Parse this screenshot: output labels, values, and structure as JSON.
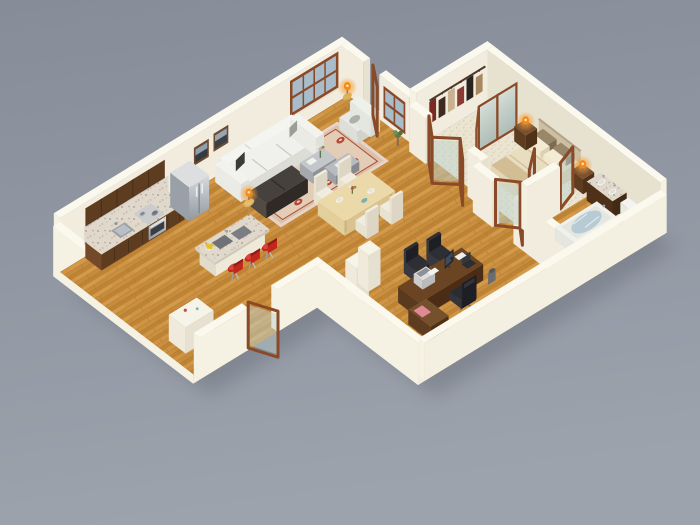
{
  "scene": {
    "type": "3d-floor-plan-render",
    "description": "Isometric 3D rendering of a one-bedroom apartment floor plan viewed from above on a gray background",
    "background": "gray gradient",
    "rooms": [
      {
        "name": "kitchen",
        "items": [
          "upper wall cabinets",
          "granite counter",
          "range with oven and pots",
          "sink",
          "stainless refrigerator",
          "granite island with prep sinks",
          "fruit bowl",
          "red bar stools"
        ]
      },
      {
        "name": "living-room",
        "items": [
          "white sofa",
          "dark sofa",
          "armchair",
          "metal coffee tables",
          "patterned area rug",
          "orange table lamps",
          "framed wall art",
          "large window",
          "open balcony door",
          "potted plant"
        ]
      },
      {
        "name": "dining-area",
        "items": [
          "light wood dining table",
          "four cream chairs",
          "plates",
          "teal bowl",
          "centerpiece"
        ]
      },
      {
        "name": "bedroom",
        "items": [
          "double bed with cream duvet",
          "brown and cream pillows",
          "headboard",
          "two nightstands",
          "orange bedside lamps",
          "beige carpet",
          "glass partition doors"
        ]
      },
      {
        "name": "closet",
        "items": [
          "clothes rod",
          "hanging garments",
          "mirrored sliding doors"
        ]
      },
      {
        "name": "home-office",
        "items": [
          "dark wood desk with return",
          "monitor",
          "printer",
          "laptop",
          "black executive chair",
          "two guest chairs",
          "waste bin",
          "white storage pillars"
        ]
      },
      {
        "name": "bathroom",
        "items": [
          "double-sink granite vanity",
          "toilet",
          "bathtub with water"
        ]
      },
      {
        "name": "entry",
        "items": [
          "open glass entry door",
          "white console cabinet"
        ]
      }
    ]
  },
  "palette": {
    "bg_top": "#868c98",
    "bg_bottom": "#9da3ad",
    "shadow": "#5f6570",
    "wall_top": "#fbf8ee",
    "wall_bright": "#f6f2e3",
    "wall_face": "#f1ecdd",
    "wall_shade": "#e7e1d0",
    "wood_base": "#c68c3c",
    "wood_light": "#d29a4a",
    "wood_dark": "#a8742d",
    "carpet_base": "#eae4d1",
    "carpet_dot": "#d6ccb2",
    "granite_base": "#e0d8ca",
    "granite_dark": "#9a9088",
    "granite_pink": "#c4a29c",
    "cabinet": "#5e3c20",
    "cabinet_light": "#73492a",
    "steel_light": "#cfd3d8",
    "steel_dark": "#979da5",
    "sofa_white": "#f0f1ed",
    "sofa_dark": "#352e2a",
    "rug_base": "#d9c2a9",
    "rug_red": "#b24a36",
    "rug_pink": "#e9d2c8",
    "wood_table": "#ecd9a9",
    "chair_cream": "#f1ecdf",
    "desk_top": "#6b4424",
    "desk_dark": "#4a2d14",
    "chair_black": "#23242a",
    "frame_brown": "#8a4a28",
    "glass": "#bdd2cd",
    "mirror_light": "#dde4de",
    "mirror_dark": "#b9c6bf",
    "orange": "#f28a1c",
    "glow": "#ffd27a",
    "fixture": "#f3f4f0",
    "fixture_shadow": "#dcded8",
    "water": "#b7cbd4",
    "bed_cream": "#e9ddc0",
    "bed_shadow": "#d8c9a5",
    "pillow_brown": "#8d7a62",
    "pillow_cream": "#f1e7cd",
    "headboard": "#cdbfa2",
    "red_stool": "#c3271c",
    "window_glass": "#a9bcc9"
  }
}
